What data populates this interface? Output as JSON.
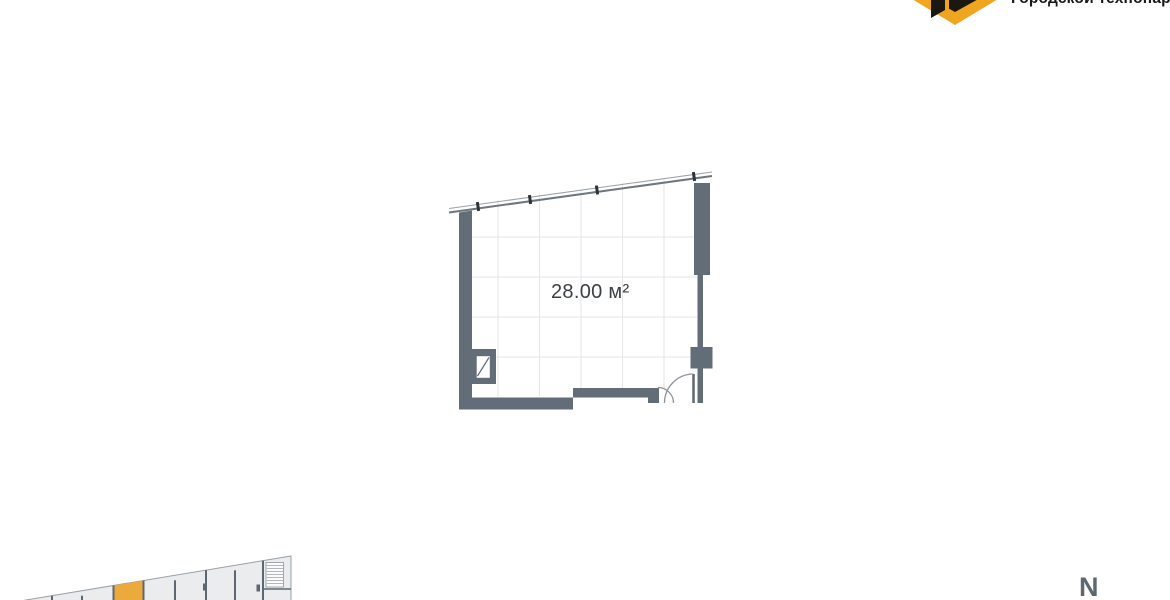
{
  "brand": {
    "name": "Городской технопарк",
    "colors": {
      "yellow": "#F0A51E",
      "black": "#1B1713"
    }
  },
  "unit_plan": {
    "area_label": "28.00 м²"
  },
  "minimap": {
    "highlight_color": "#ECAA3D"
  },
  "compass": {
    "north_label": "N"
  },
  "colors": {
    "wall": "#636D77",
    "grid": "#E4E6E9",
    "room_fill": "#EAECEE",
    "window_line": "#6E767E",
    "arc_line": "#8E959C"
  }
}
